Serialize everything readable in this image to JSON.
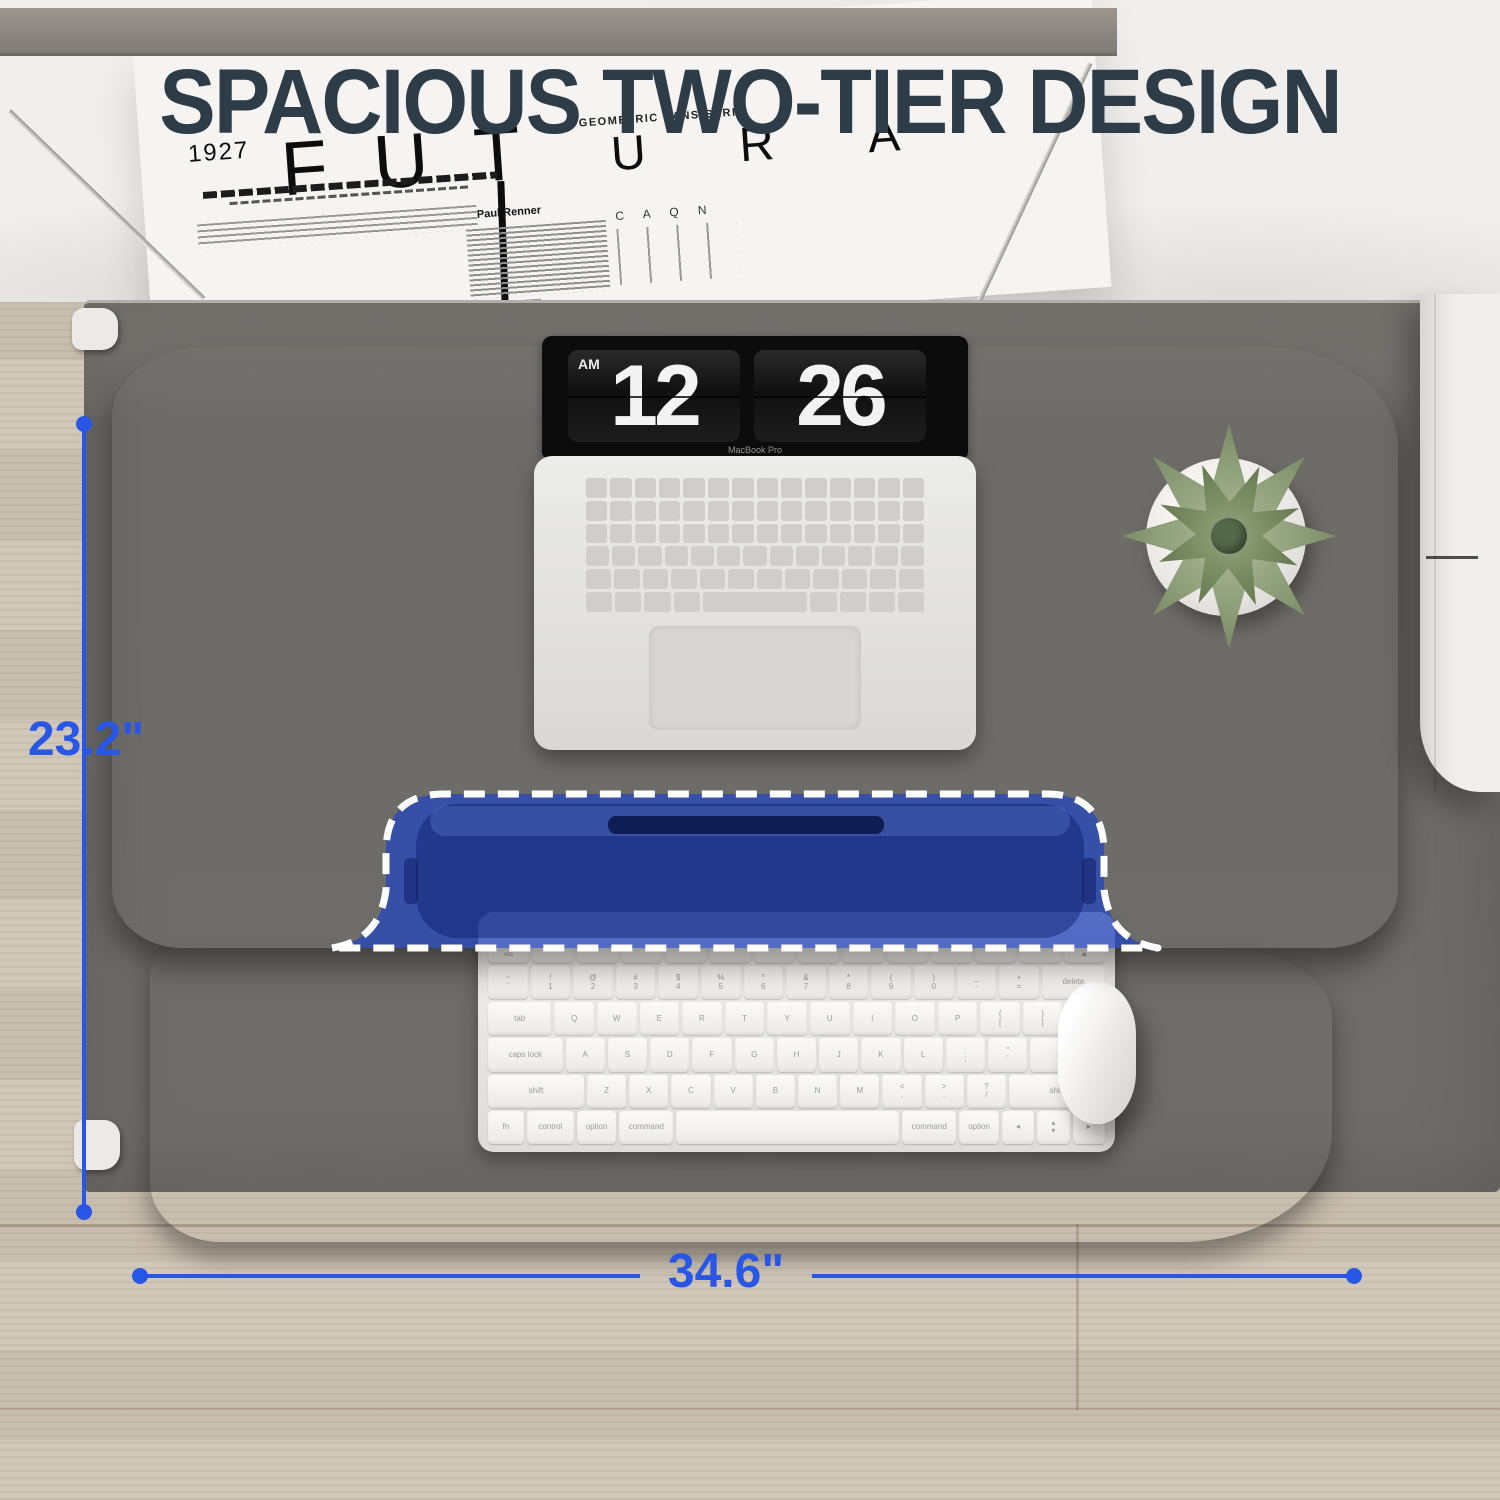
{
  "header": {
    "title": "SPACIOUS TWO-TIER DESIGN"
  },
  "poster": {
    "year": "1927",
    "name_part1": "FUT",
    "name_part2": "URA",
    "subtitle": "GEOMETRIC SANS-SERIF",
    "designer": "Paul Renner",
    "specimen_letters": "C A Q N"
  },
  "desk": {
    "clock": {
      "meridiem": "AM",
      "hours": "12",
      "minutes": "26",
      "brand": "MacBook Pro"
    },
    "dimensions": {
      "depth": "23.2\"",
      "width": "34.6\""
    }
  },
  "keyboard": {
    "rows": [
      [
        "esc",
        "",
        "",
        "",
        "",
        "",
        "",
        "",
        "",
        "",
        "",
        "",
        "",
        "⏏"
      ],
      [
        "~\n`",
        "!\n1",
        "@\n2",
        "#\n3",
        "$\n4",
        "%\n5",
        "^\n6",
        "&\n7",
        "*\n8",
        "(\n9",
        ")\n0",
        "_\n-",
        "+\n=",
        "delete"
      ],
      [
        "tab",
        "Q",
        "W",
        "E",
        "R",
        "T",
        "Y",
        "U",
        "I",
        "O",
        "P",
        "{\n[",
        "}\n]",
        "|\n\\"
      ],
      [
        "caps lock",
        "A",
        "S",
        "D",
        "F",
        "G",
        "H",
        "J",
        "K",
        "L",
        ":\n;",
        "\"\n'",
        "return"
      ],
      [
        "shift",
        "Z",
        "X",
        "C",
        "V",
        "B",
        "N",
        "M",
        "<\n,",
        ">\n.",
        "?\n/",
        "shift"
      ],
      [
        "fn",
        "control",
        "option",
        "command",
        "",
        "command",
        "option",
        "◂",
        "▴\n▾",
        "▸"
      ]
    ]
  },
  "colors": {
    "accent_blue": "#2857e8",
    "slot_blue": "#2646b9",
    "title_ink": "#2d3c46",
    "wood_dark": "#4a3322",
    "wood_mid": "#5a4230",
    "wood_light": "#6b5140",
    "mat_gray": "#6f6d6a",
    "floor_beige": "#cfc5b7",
    "poster_white": "#f5f4f2"
  }
}
